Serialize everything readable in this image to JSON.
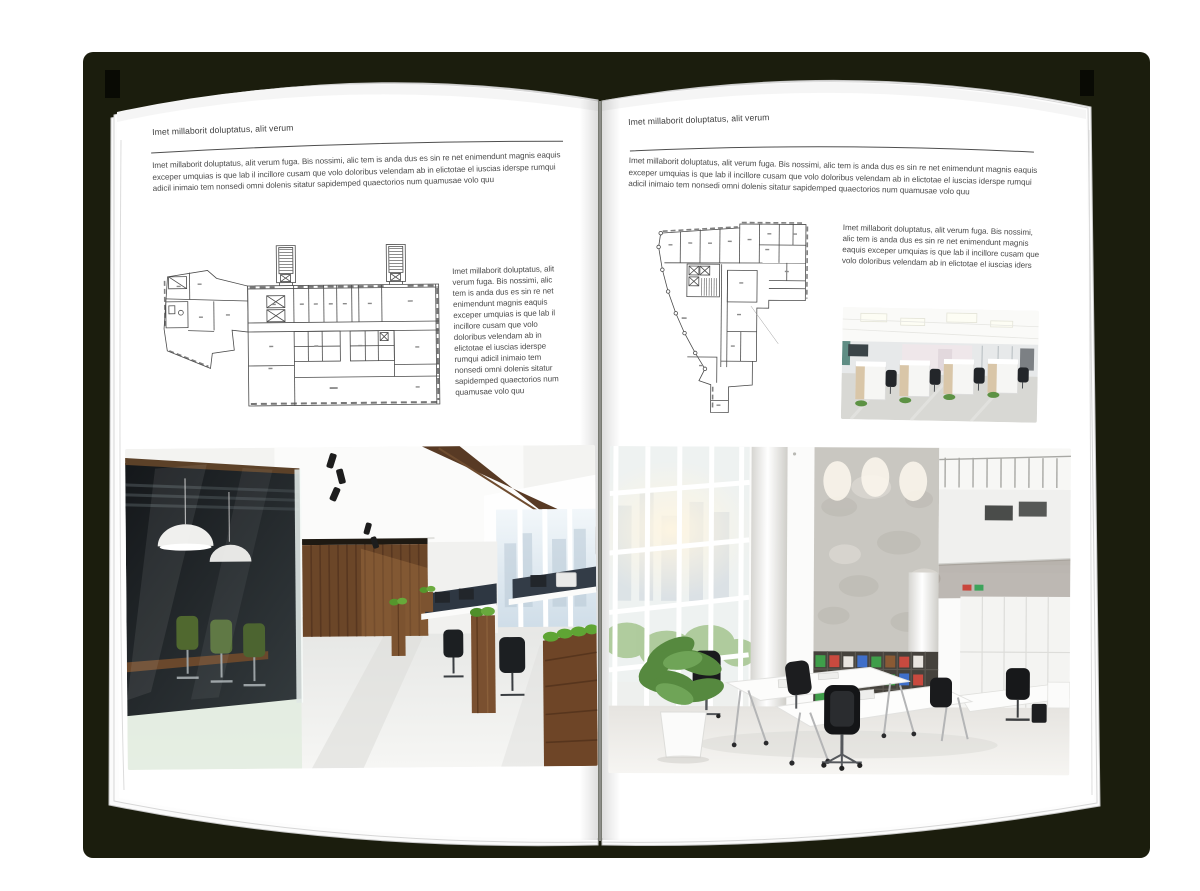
{
  "book": {
    "left_page": {
      "title": "Imet millaborit doluptatus, alit verum",
      "intro": "Imet millaborit doluptatus, alit verum fuga. Bis nossimi, alic tem is anda dus es sin re net enimendunt magnis eaquis exceper umquias is que lab il incillore cusam que volo doloribus velendam ab in elictotae el iuscias iderspe rumqui adicil inimaio tem nonsedi omni dolenis sitatur sapidemped quaectorios num quamusae volo quu",
      "side_text": "Imet millaborit doluptatus, alit verum fuga. Bis nossimi, alic tem is anda dus es sin re net enimendunt magnis eaquis exceper umquias is que lab il incillore cusam que volo doloribus velendam ab in elictotae el iuscias iderspe rumqui adicil inimaio tem nonsedi omni dolenis sitatur sapidemped quaectorios num quamusae volo quu"
    },
    "right_page": {
      "title": "Imet millaborit doluptatus, alit verum",
      "intro": "Imet millaborit doluptatus, alit verum fuga. Bis nossimi, alic tem is anda dus es sin re net enimendunt magnis eaquis exceper umquias is que lab il incillore cusam que volo doloribus velendam ab in elictotae el iuscias iderspe rumqui adicil inimaio tem nonsedi omni dolenis sitatur sapidemped quaectorios num quamusae volo quu",
      "side_text": "Imet millaborit doluptatus, alit verum fuga. Bis nossimi, alic tem is anda dus es sin re net enimendunt magnis eaquis exceper umquias is que lab il incillore cusam que volo doloribus velendam ab in elictotae el iuscias iders"
    },
    "colors": {
      "backdrop": "#1b1d0d",
      "page": "#ffffff",
      "rule_line": "#4f4f4f",
      "body_text": "#4a4a4a",
      "plan_line": "#4a4a4a"
    }
  }
}
